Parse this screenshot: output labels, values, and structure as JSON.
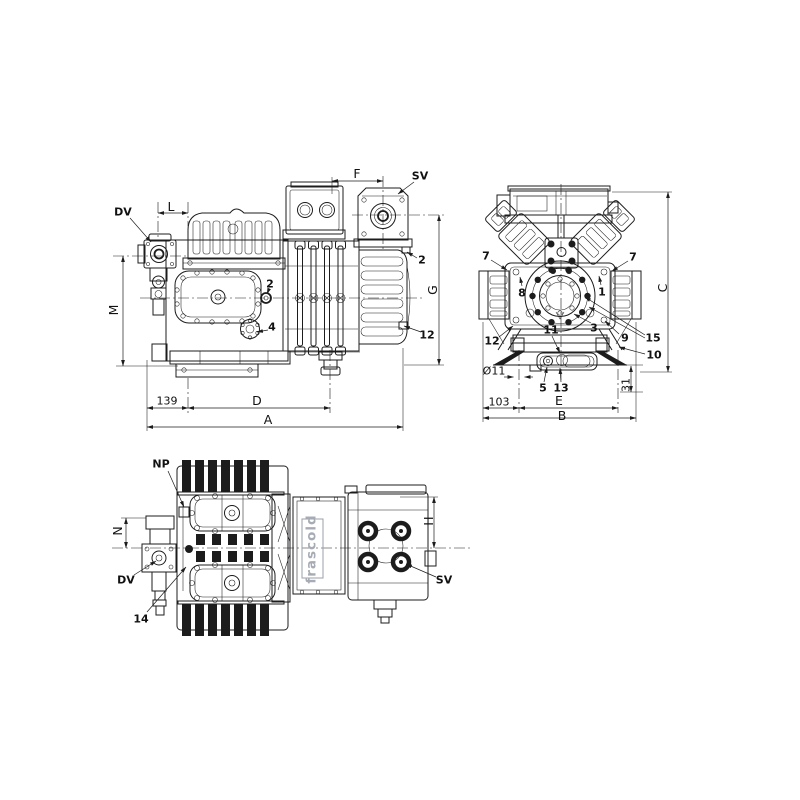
{
  "page": {
    "background": "#ffffff",
    "line_color": "#1c1c1c"
  },
  "logo": {
    "text": "frascold",
    "color": "#a7acb4"
  },
  "side_view": {
    "callouts": {
      "dv": "DV",
      "sv": "SV",
      "n2_valve": "2",
      "n2_body": "2",
      "n4": "4",
      "n12": "12"
    },
    "dims": {
      "l": "L",
      "f": "F",
      "m": "M",
      "g": "G",
      "d": "D",
      "a": "A",
      "n139": "139"
    }
  },
  "front_view": {
    "callouts": {
      "n7_left": "7",
      "n7_right": "7",
      "n8": "8",
      "n1": "1",
      "n12": "12",
      "n11": "11",
      "n3": "3",
      "n9": "9",
      "n15": "15",
      "n10": "10",
      "n5": "5",
      "n13": "13"
    },
    "dims": {
      "c": "C",
      "e": "E",
      "b": "B",
      "n103": "103",
      "n31": "31",
      "dia11": "Ø11"
    }
  },
  "top_view": {
    "callouts": {
      "np": "NP",
      "dv": "DV",
      "sv": "SV",
      "n14": "14"
    },
    "dims": {
      "n": "N",
      "h": "H"
    }
  }
}
